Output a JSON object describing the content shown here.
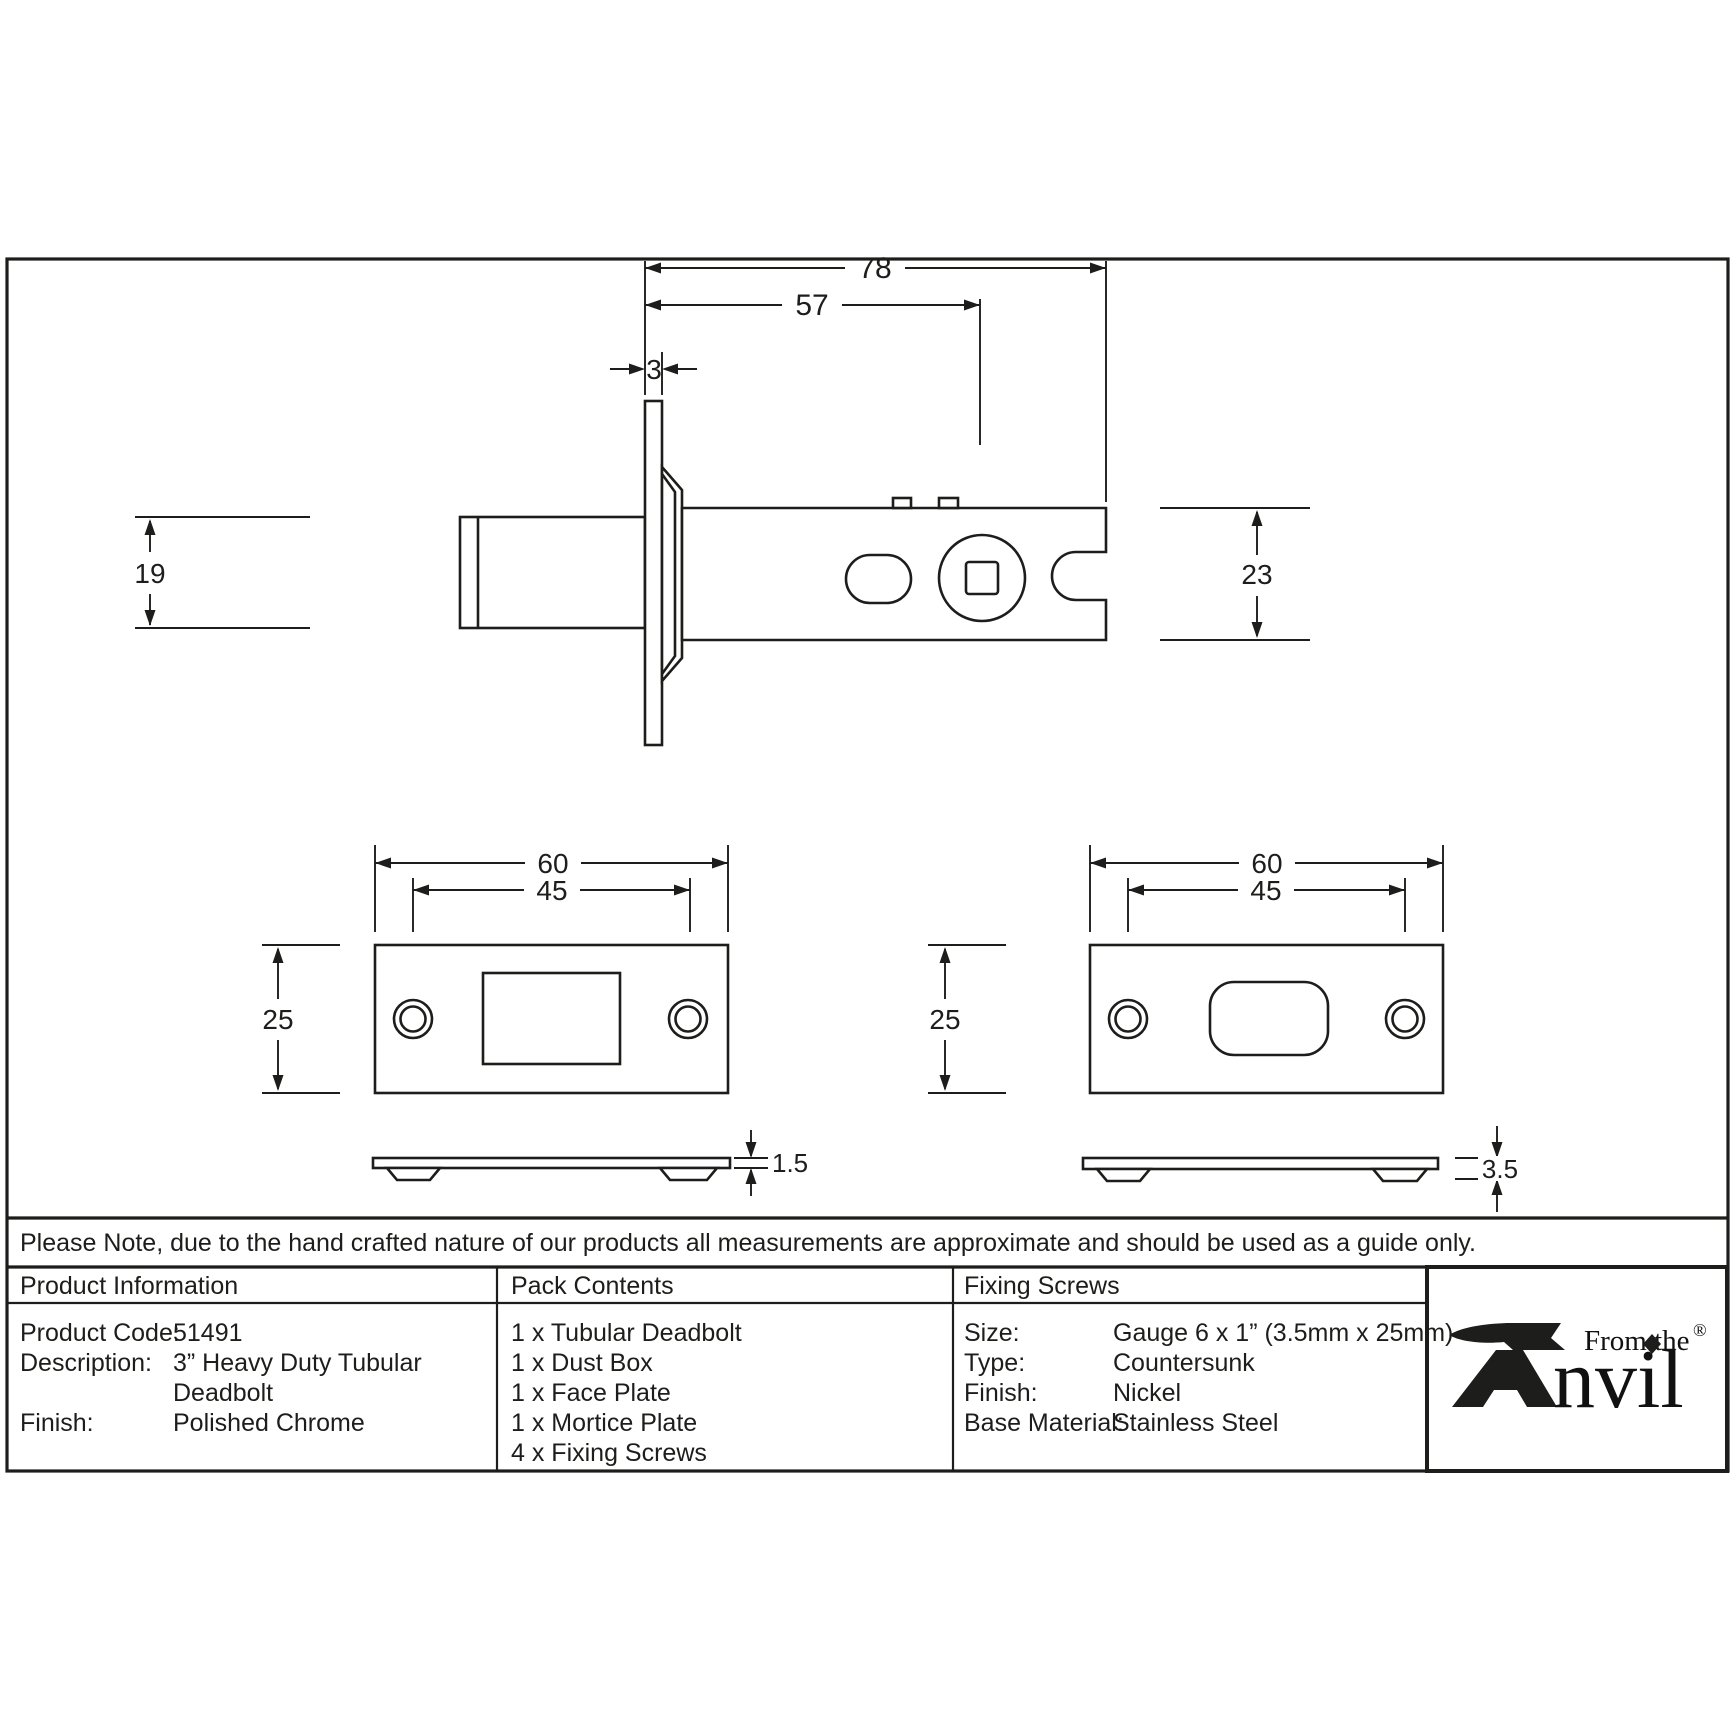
{
  "drawing": {
    "deadbolt_side_view": {
      "overall_length": "78",
      "backset": "57",
      "faceplate_thickness": "3",
      "bolt_height": "19",
      "case_height": "23"
    },
    "face_plate_view": {
      "width": "60",
      "screw_spacing": "45",
      "height": "25",
      "thickness": "1.5"
    },
    "mortice_plate_view": {
      "width": "60",
      "screw_spacing": "45",
      "height": "25",
      "thickness": "3.5"
    }
  },
  "note": "Please Note, due to the hand crafted nature of our products all measurements are approximate and should be used as a guide only.",
  "table": {
    "product_information": {
      "header": "Product Information",
      "rows": [
        {
          "label": "Product Code:",
          "value": "51491"
        },
        {
          "label": "Description:",
          "value": "3” Heavy Duty Tubular"
        },
        {
          "label": "",
          "value": "Deadbolt"
        },
        {
          "label": "Finish:",
          "value": "Polished Chrome"
        }
      ]
    },
    "pack_contents": {
      "header": "Pack Contents",
      "items": [
        "1 x Tubular Deadbolt",
        "1 x Dust Box",
        "1 x Face Plate",
        "1 x Mortice Plate",
        "4 x Fixing Screws"
      ]
    },
    "fixing_screws": {
      "header": "Fixing Screws",
      "rows": [
        {
          "label": "Size:",
          "value": "Gauge 6 x 1” (3.5mm x 25mm)"
        },
        {
          "label": "Type:",
          "value": "Countersunk"
        },
        {
          "label": "Finish:",
          "value": "Nickel"
        },
        {
          "label": "Base Material:",
          "value": "Stainless Steel"
        }
      ]
    }
  },
  "logo": {
    "prefix": "From the",
    "name_rest": "nvil",
    "registered": "®"
  },
  "colors": {
    "line": "#1d1d1b",
    "background": "#ffffff"
  }
}
